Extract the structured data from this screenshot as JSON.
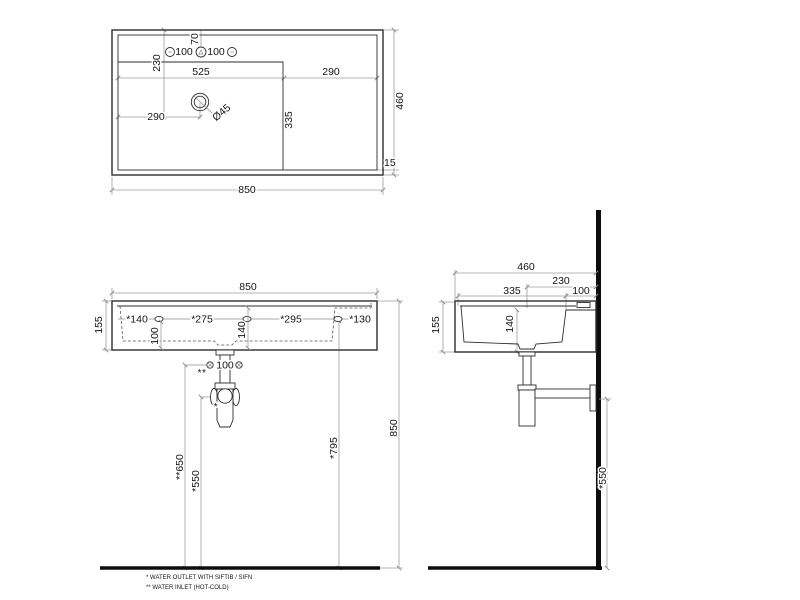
{
  "colors": {
    "background": "#ffffff",
    "geometry": "#2e2e2e",
    "dimension_lines": "#9c9c9c",
    "text": "#151515",
    "wall": "#0d0d0d"
  },
  "top_view": {
    "overall_width": "850",
    "overall_depth": "460",
    "bowl_width": "525",
    "right_deck_width": "290",
    "drain_from_left": "290",
    "drain_from_rear": "230",
    "hole_from_rear": "70",
    "hole_gap_left": "100",
    "hole_gap_right": "100",
    "bowl_depth": "335",
    "front_rim": "15",
    "drain_diameter": "Ø45"
  },
  "front_view": {
    "overall_width": "850",
    "height": "155",
    "edge_to_hole1": "*140",
    "hole1_to_hole2": "*275",
    "hole2_to_hole3": "*295",
    "hole3_to_edge": "*130",
    "hole_drop": "100",
    "inner_height": "140",
    "inlet_spacing": "100",
    "inlet_mark": "**",
    "outlet_mark": "*",
    "inlet_height": "**650",
    "outlet_height": "*550",
    "hole_height": "*795",
    "rim_height": "850"
  },
  "side_view": {
    "overall_depth": "460",
    "wall_to_drain": "230",
    "bowl_depth": "335",
    "wall_to_bowl": "100",
    "height": "155",
    "inner_depth": "140",
    "outlet_height": "*550"
  },
  "notes": {
    "outlet": "* WATER OUTLET WITH SIFTIB / SIFN",
    "inlet": "** WATER INLET  (HOT-COLD)"
  }
}
